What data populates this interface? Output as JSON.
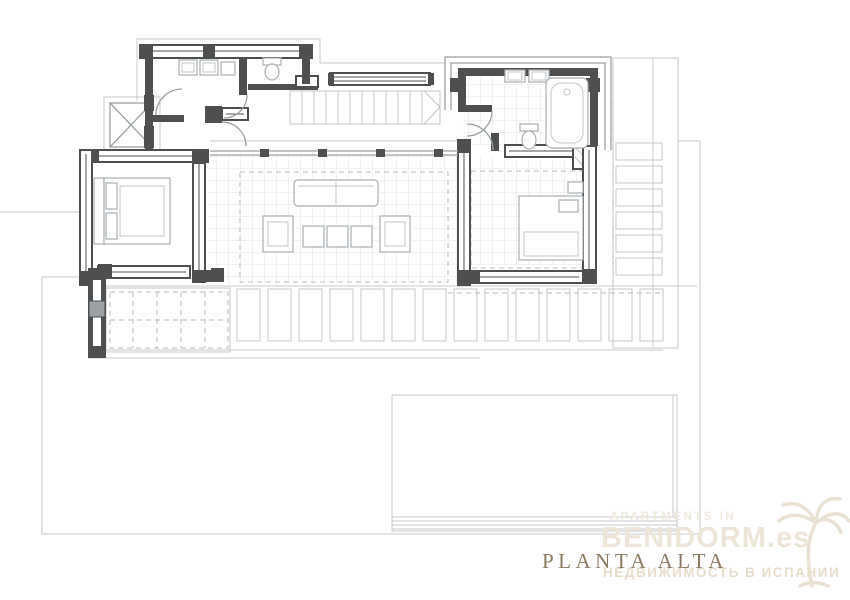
{
  "page": {
    "width": 850,
    "height": 600,
    "background": "#ffffff"
  },
  "drawing": {
    "title": "PLANTA ALTA",
    "title_color": "#8d7a63",
    "type": "architectural-floor-plan",
    "features": [
      "bathroom-left",
      "wc",
      "elevator-shaft",
      "staircase",
      "hall",
      "bathroom-right",
      "bedroom-left",
      "living-terrace",
      "bedroom-right",
      "pergola-louvers",
      "swimming-pool",
      "plot-boundary"
    ],
    "colors": {
      "wall": "#4d4f50",
      "line_light": "#c6cacc",
      "line_mid": "#9aa0a3",
      "furniture": "#a9afb2",
      "grid": "#e3e6e7",
      "dashed": "#b8bcbe"
    }
  },
  "watermark": {
    "line1": "APARTMENTS IN",
    "line2": "BENIDORM.es",
    "line3": "НЕДВИЖИМОСТЬ В ИСПАНИИ",
    "color_light": "#ece5d8",
    "palm_icon": "palm-tree-icon"
  }
}
